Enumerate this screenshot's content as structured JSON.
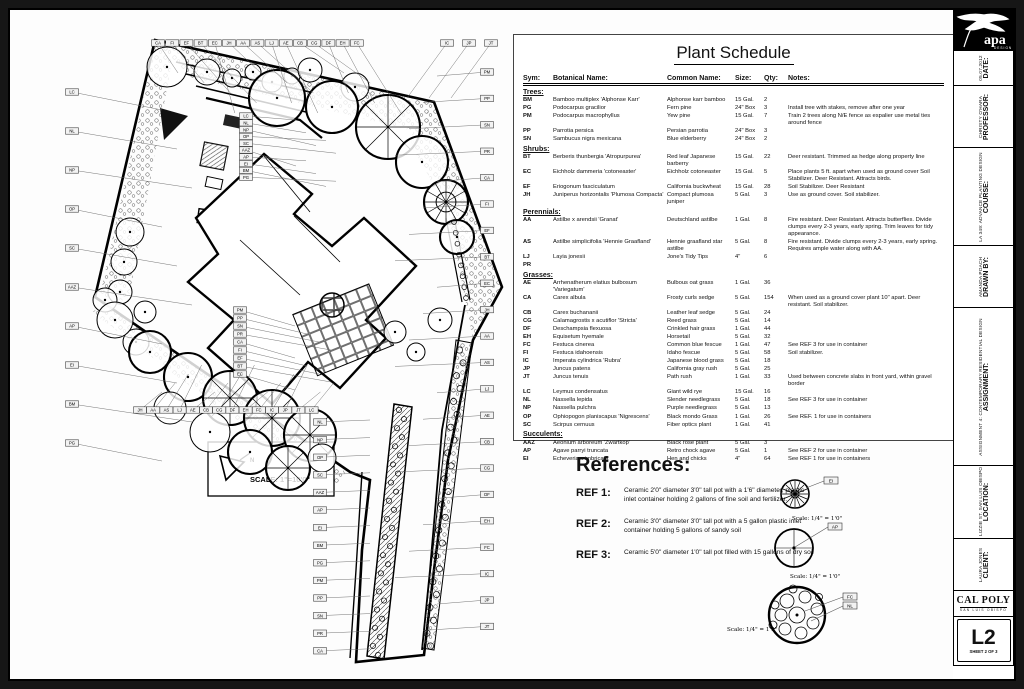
{
  "plan": {
    "scale_label": "SCALE: 1\"=10'0\"",
    "north_label": "N",
    "callout_codes": [
      "CA",
      "FI",
      "EF",
      "BT",
      "EC",
      "JH",
      "AA",
      "AS",
      "LJ",
      "AE",
      "CB",
      "CG",
      "DF",
      "EH",
      "FC",
      "IC",
      "JP",
      "JT",
      "LC",
      "NL",
      "NP",
      "OP",
      "SC",
      "AAZ",
      "AP",
      "EI",
      "BM",
      "PG",
      "PM",
      "PP",
      "SN",
      "PR"
    ]
  },
  "plant_schedule": {
    "title": "Plant Schedule",
    "columns": [
      "Sym:",
      "Botanical Name:",
      "Common Name:",
      "Size:",
      "Qty:",
      "Notes:"
    ],
    "sections": [
      {
        "name": "Trees:",
        "rows": [
          {
            "sym": "BM",
            "botanical": "Bamboo multiplex 'Alphonse Karr'",
            "common": "Alphonse karr bamboo",
            "size": "15 Gal.",
            "qty": "2",
            "notes": ""
          },
          {
            "sym": "PG",
            "botanical": "Podocarpus gracilior",
            "common": "Fern pine",
            "size": "24\" Box",
            "qty": "3",
            "notes": "Install tree with stakes, remove after one year"
          },
          {
            "sym": "PM",
            "botanical": "Podocarpus macrophyllus",
            "common": "Yew pine",
            "size": "15 Gal.",
            "qty": "7",
            "notes": "Train 2 trees along N/E fence as espalier use metal ties around fence"
          },
          {
            "sym": "PP",
            "botanical": "Parrotia persica",
            "common": "Persian parrotia",
            "size": "24\" Box",
            "qty": "3",
            "notes": ""
          },
          {
            "sym": "SN",
            "botanical": "Sambucus nigra mexicana",
            "common": "Blue elderberry",
            "size": "24\" Box",
            "qty": "2",
            "notes": ""
          }
        ]
      },
      {
        "name": "Shrubs:",
        "rows": [
          {
            "sym": "BT",
            "botanical": "Berberis thunbergia 'Atropurpurea'",
            "common": "Red leaf Japanese barberry",
            "size": "15 Gal.",
            "qty": "22",
            "notes": "Deer resistant. Trimmed as hedge along property line"
          },
          {
            "sym": "EC",
            "botanical": "Eichholz dammeria 'cotoneaster'",
            "common": "Eichholz cotoneaster",
            "size": "15 Gal.",
            "qty": "5",
            "notes": "Place plants 5 ft. apart when used as ground cover Soil Stabilizer. Deer Resistant.  Attracts birds."
          },
          {
            "sym": "EF",
            "botanical": "Eriogonum fasciculatum",
            "common": "California buckwheat",
            "size": "15 Gal.",
            "qty": "28",
            "notes": "Soil Stabilizer. Deer Resistant"
          },
          {
            "sym": "JH",
            "botanical": "Juniperus horizontalis 'Plumosa Compacta'",
            "common": "Compact plumosa juniper",
            "size": "5 Gal.",
            "qty": "3",
            "notes": "Use as ground cover.  Soil stabilizer."
          }
        ]
      },
      {
        "name": "Perennials:",
        "rows": [
          {
            "sym": "AA",
            "botanical": "Astilbe x arendsii 'Granat'",
            "common": "Deutschland astilbe",
            "size": "1 Gal.",
            "qty": "8",
            "notes": "Fire resistant. Deer Resistant. Attracts butterflies. Divide clumps every 2-3 years, early spring. Trim leaves for tidy appearance."
          },
          {
            "sym": "AS",
            "botanical": "Astilbe simplicifolia 'Hennie Graafland'",
            "common": "Hennie graafland star astilbe",
            "size": "5 Gal.",
            "qty": "8",
            "notes": "Fire resistant. Divide clumps every 2-3 years, early spring.    Requires ample water along with AA."
          },
          {
            "sym": "LJ",
            "botanical": "Layia jonesii",
            "common": "Jone's Tidy Tips",
            "size": "4\"",
            "qty": "6",
            "notes": ""
          },
          {
            "sym": "PR",
            "botanical": "",
            "common": "",
            "size": "",
            "qty": "",
            "notes": ""
          }
        ]
      },
      {
        "name": "Grasses:",
        "rows": [
          {
            "sym": "AE",
            "botanical": "Arrhenatherum elatius bulbosum 'Variegatum'",
            "common": "Bulbous oat grass",
            "size": "1 Gal.",
            "qty": "36",
            "notes": ""
          },
          {
            "sym": "CA",
            "botanical": "Carex albula",
            "common": "Frosty curls sedge",
            "size": "5 Gal.",
            "qty": "154",
            "notes": "When used as a ground cover plant 10\" apart. Deer resistant.  Soil stabilizer."
          },
          {
            "sym": "CB",
            "botanical": "Carex buchananii",
            "common": "Leather leaf sedge",
            "size": "5 Gal.",
            "qty": "24",
            "notes": ""
          },
          {
            "sym": "CG",
            "botanical": "Calamagrostis x acutiflor 'Stricta'",
            "common": "Reed grass",
            "size": "5 Gal.",
            "qty": "14",
            "notes": ""
          },
          {
            "sym": "DF",
            "botanical": "Deschampsia flexuosa",
            "common": "Crinkled hair grass",
            "size": "1 Gal.",
            "qty": "44",
            "notes": ""
          },
          {
            "sym": "EH",
            "botanical": "Equisetum hyemale",
            "common": "Horsetail",
            "size": "5 Gal.",
            "qty": "32",
            "notes": ""
          },
          {
            "sym": "FC",
            "botanical": "Festuca cinerea",
            "common": "Common blue fescue",
            "size": "1 Gal.",
            "qty": "47",
            "notes": "See REF 3 for use in container"
          },
          {
            "sym": "FI",
            "botanical": "Festuca idahoensis",
            "common": "Idaho fescue",
            "size": "5 Gal.",
            "qty": "58",
            "notes": "Soil stabilizer."
          },
          {
            "sym": "IC",
            "botanical": "Imperata cylindrica 'Rubra'",
            "common": "Japanese blood grass",
            "size": "5 Gal.",
            "qty": "18",
            "notes": ""
          },
          {
            "sym": "JP",
            "botanical": "Juncus patens",
            "common": "California gray rush",
            "size": "5 Gal.",
            "qty": "25",
            "notes": ""
          },
          {
            "sym": "JT",
            "botanical": "Juncus tenuis",
            "common": "Path rush",
            "size": "1 Gal.",
            "qty": "33",
            "notes": "Used between concrete slabs in front yard, within gravel border"
          },
          {
            "sym": "LC",
            "botanical": "Leymus condensatus",
            "common": "Giant wild rye",
            "size": "15 Gal.",
            "qty": "16",
            "notes": ""
          },
          {
            "sym": "NL",
            "botanical": "Nassella lepida",
            "common": "Slender needlegrass",
            "size": "5 Gal.",
            "qty": "18",
            "notes": "See REF 3 for use in container"
          },
          {
            "sym": "NP",
            "botanical": "Nassella pulchra",
            "common": "Purple needlegrass",
            "size": "5 Gal.",
            "qty": "13",
            "notes": ""
          },
          {
            "sym": "OP",
            "botanical": "Ophiopogon planiscapus 'Nigrescens'",
            "common": "Black mondo Grass",
            "size": "1 Gal.",
            "qty": "26",
            "notes": "See REF. 1 for use in containers"
          },
          {
            "sym": "SC",
            "botanical": "Scirpus cernuus",
            "common": "Fiber optics plant",
            "size": "1 Gal.",
            "qty": "41",
            "notes": ""
          }
        ]
      },
      {
        "name": "Succulents:",
        "rows": [
          {
            "sym": "AAZ",
            "botanical": "Aeonium arboreum 'Zwartkop'",
            "common": "Black rose plant",
            "size": "5 Gal.",
            "qty": "3",
            "notes": ""
          },
          {
            "sym": "AP",
            "botanical": "Agave parryi truncata",
            "common": "Retro chock agave",
            "size": "5 Gal.",
            "qty": "1",
            "notes": "See REF 2 for use in container"
          },
          {
            "sym": "EI",
            "botanical": "Echeveria x imbricata",
            "common": "Hen and chicks",
            "size": "4\"",
            "qty": "64",
            "notes": "See REF 1 for use in containers"
          }
        ]
      }
    ]
  },
  "references": {
    "heading": "References:",
    "items": [
      {
        "label": "REF 1:",
        "text": "Ceramic 2'0\" diameter 3'0\" tall pot with a 1'6\" diameter, plastic inlet container holding 2 gallons of fine soil and fertilizer."
      },
      {
        "label": "REF 2:",
        "text": "Ceramic 3'0\" diameter 3'0\" tall pot with a 5 gallon plastic inlet container holding 5 gallons of sandy soil"
      },
      {
        "label": "REF 3:",
        "text": "Ceramic 5'0\" diameter 1'0\" tall pot filled with 15 gallons of dry soil"
      }
    ],
    "diagrams": [
      {
        "callouts": [
          "EI"
        ],
        "scale": "Scale: 1/4\" = 1'0\""
      },
      {
        "callouts": [
          "AP"
        ],
        "scale": "Scale: 1/4\" = 1'0\""
      },
      {
        "callouts": [
          "FC",
          "NL"
        ],
        "scale": "Scale: 1/4\" = 1'0\""
      }
    ]
  },
  "title_block": {
    "logo": {
      "name": "apa",
      "sub": "DESIGN"
    },
    "cells": [
      {
        "label": "DATE:",
        "value": "05.07.2012"
      },
      {
        "label": "PROFESSOR:",
        "value": "CHRISTY O'HARA"
      },
      {
        "label": "COURSE:",
        "value": "LA 349: ADVANCE PLANTING DESIGN"
      },
      {
        "label": "DRAWN BY:",
        "value": "AMANDA POACH"
      },
      {
        "label": "ASSIGNMENT:",
        "value": "ASSIGNMENT 4: CONTEMPORARY RESIDENTIAL DESIGN"
      },
      {
        "label": "LOCATION:",
        "value": "LIZZIE ST. SAN LUIS OBISPO"
      },
      {
        "label": "CLIENT:",
        "value": "LAURA JONES"
      }
    ],
    "branding": {
      "name": "CAL POLY",
      "sub": "SAN LUIS OBISPO"
    },
    "sheet_number": {
      "code": "L2",
      "label": "SHEET 2 OF 3"
    }
  }
}
